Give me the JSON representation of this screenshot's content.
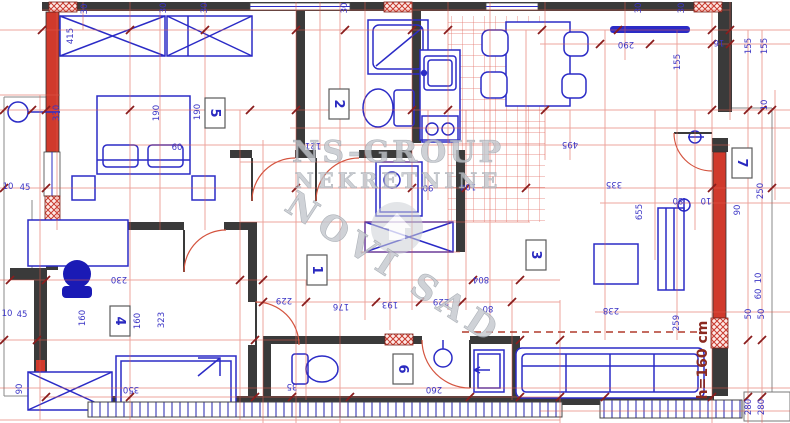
{
  "watermark": {
    "line1": "NS-GROUP",
    "line2": "NEKRETNINE",
    "line3": "NOVI SAD"
  },
  "height_note": "h=160 cm",
  "rooms": [
    {
      "number": "1",
      "x": 317,
      "y": 270
    },
    {
      "number": "2",
      "x": 339,
      "y": 104
    },
    {
      "number": "3",
      "x": 536,
      "y": 255
    },
    {
      "number": "4",
      "x": 120,
      "y": 321
    },
    {
      "number": "5",
      "x": 215,
      "y": 113
    },
    {
      "number": "6",
      "x": 403,
      "y": 369
    },
    {
      "number": "7",
      "x": 742,
      "y": 163
    }
  ],
  "dims": [
    {
      "t": "30",
      "x": 84,
      "y": 9,
      "r": -90
    },
    {
      "t": "30",
      "x": 163,
      "y": 8,
      "r": -90
    },
    {
      "t": "30",
      "x": 204,
      "y": 8,
      "r": -90
    },
    {
      "t": "30",
      "x": 344,
      "y": 8,
      "r": -90
    },
    {
      "t": "30",
      "x": 638,
      "y": 8,
      "r": -90
    },
    {
      "t": "30",
      "x": 681,
      "y": 8,
      "r": -90
    },
    {
      "t": "415",
      "x": 70,
      "y": 36,
      "r": -90
    },
    {
      "t": "330",
      "x": 56,
      "y": 113,
      "r": -90
    },
    {
      "t": "190",
      "x": 156,
      "y": 113,
      "r": -90
    },
    {
      "t": "190",
      "x": 197,
      "y": 112,
      "r": -90
    },
    {
      "t": "60",
      "x": 177,
      "y": 147,
      "r": 0
    },
    {
      "t": "45",
      "x": 25,
      "y": 187,
      "r": 0
    },
    {
      "t": "10",
      "x": 8,
      "y": 186,
      "r": 0
    },
    {
      "t": "121",
      "x": 313,
      "y": 146,
      "r": 180
    },
    {
      "t": "230",
      "x": 119,
      "y": 280,
      "r": 180
    },
    {
      "t": "45",
      "x": 22,
      "y": 314,
      "r": 0
    },
    {
      "t": "10",
      "x": 7,
      "y": 313,
      "r": 0
    },
    {
      "t": "160",
      "x": 82,
      "y": 318,
      "r": -90
    },
    {
      "t": "160",
      "x": 137,
      "y": 321,
      "r": -90
    },
    {
      "t": "323",
      "x": 161,
      "y": 320,
      "r": -90
    },
    {
      "t": "350",
      "x": 131,
      "y": 390,
      "r": 180
    },
    {
      "t": "90",
      "x": 19,
      "y": 389,
      "r": -90
    },
    {
      "t": "90",
      "x": 428,
      "y": 188,
      "r": 180
    },
    {
      "t": "104",
      "x": 468,
      "y": 187,
      "r": 180
    },
    {
      "t": "229",
      "x": 284,
      "y": 301,
      "r": 180
    },
    {
      "t": "176",
      "x": 341,
      "y": 307,
      "r": 180
    },
    {
      "t": "193",
      "x": 390,
      "y": 305,
      "r": 180
    },
    {
      "t": "229",
      "x": 441,
      "y": 302,
      "r": 180
    },
    {
      "t": "80",
      "x": 488,
      "y": 309,
      "r": 180
    },
    {
      "t": "804",
      "x": 481,
      "y": 280,
      "r": 180
    },
    {
      "t": "35",
      "x": 292,
      "y": 387,
      "r": 180
    },
    {
      "t": "260",
      "x": 434,
      "y": 390,
      "r": 180
    },
    {
      "t": "290",
      "x": 626,
      "y": 45,
      "r": 180
    },
    {
      "t": "16",
      "x": 719,
      "y": 43,
      "r": 180
    },
    {
      "t": "155",
      "x": 677,
      "y": 62,
      "r": -90
    },
    {
      "t": "155",
      "x": 748,
      "y": 46,
      "r": -90
    },
    {
      "t": "155",
      "x": 764,
      "y": 46,
      "r": -90
    },
    {
      "t": "10",
      "x": 764,
      "y": 105,
      "r": -90
    },
    {
      "t": "495",
      "x": 570,
      "y": 145,
      "r": 180
    },
    {
      "t": "335",
      "x": 614,
      "y": 185,
      "r": 180
    },
    {
      "t": "655",
      "x": 639,
      "y": 212,
      "r": -90
    },
    {
      "t": "80",
      "x": 678,
      "y": 201,
      "r": 180
    },
    {
      "t": "10",
      "x": 706,
      "y": 201,
      "r": 180
    },
    {
      "t": "90",
      "x": 737,
      "y": 210,
      "r": -90
    },
    {
      "t": "250",
      "x": 760,
      "y": 191,
      "r": -90
    },
    {
      "t": "238",
      "x": 611,
      "y": 311,
      "r": 180
    },
    {
      "t": "259",
      "x": 676,
      "y": 323,
      "r": -90
    },
    {
      "t": "50",
      "x": 748,
      "y": 314,
      "r": -90
    },
    {
      "t": "50",
      "x": 761,
      "y": 314,
      "r": -90
    },
    {
      "t": "10",
      "x": 758,
      "y": 278,
      "r": -90
    },
    {
      "t": "60",
      "x": 758,
      "y": 294,
      "r": -90
    },
    {
      "t": "280",
      "x": 748,
      "y": 407,
      "r": -90
    },
    {
      "t": "280",
      "x": 761,
      "y": 407,
      "r": -90
    }
  ],
  "colors": {
    "walls": "#3a3a3a",
    "furniture": "#2b2bc6",
    "dimension_lines": "#dd5a4c",
    "dimension_text": "#3b35c5",
    "red_wall": "#d03a2c",
    "watermark": "#c2c6cc",
    "height_note_color": "#8b2a20"
  }
}
